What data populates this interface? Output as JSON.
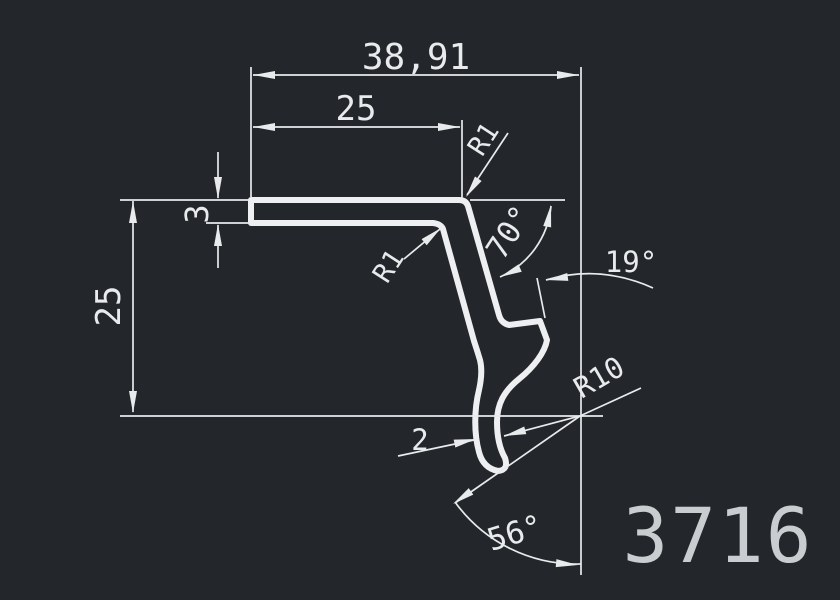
{
  "drawing": {
    "background_color": "#23272c",
    "line_color": "#edeff0",
    "part_number": "3716",
    "part_number_color": "#c9cdd0",
    "dimensions": {
      "overall_width": "38,91",
      "top_flange_length": "25",
      "flange_thickness": "3",
      "overall_height": "25",
      "top_corner_radius": "R1",
      "inner_corner_radius": "R1",
      "leg_angle": "70°",
      "lip_angle": "19°",
      "hook_radius": "R10",
      "hook_wall_thickness": "2",
      "hook_end_angle": "56°"
    }
  }
}
